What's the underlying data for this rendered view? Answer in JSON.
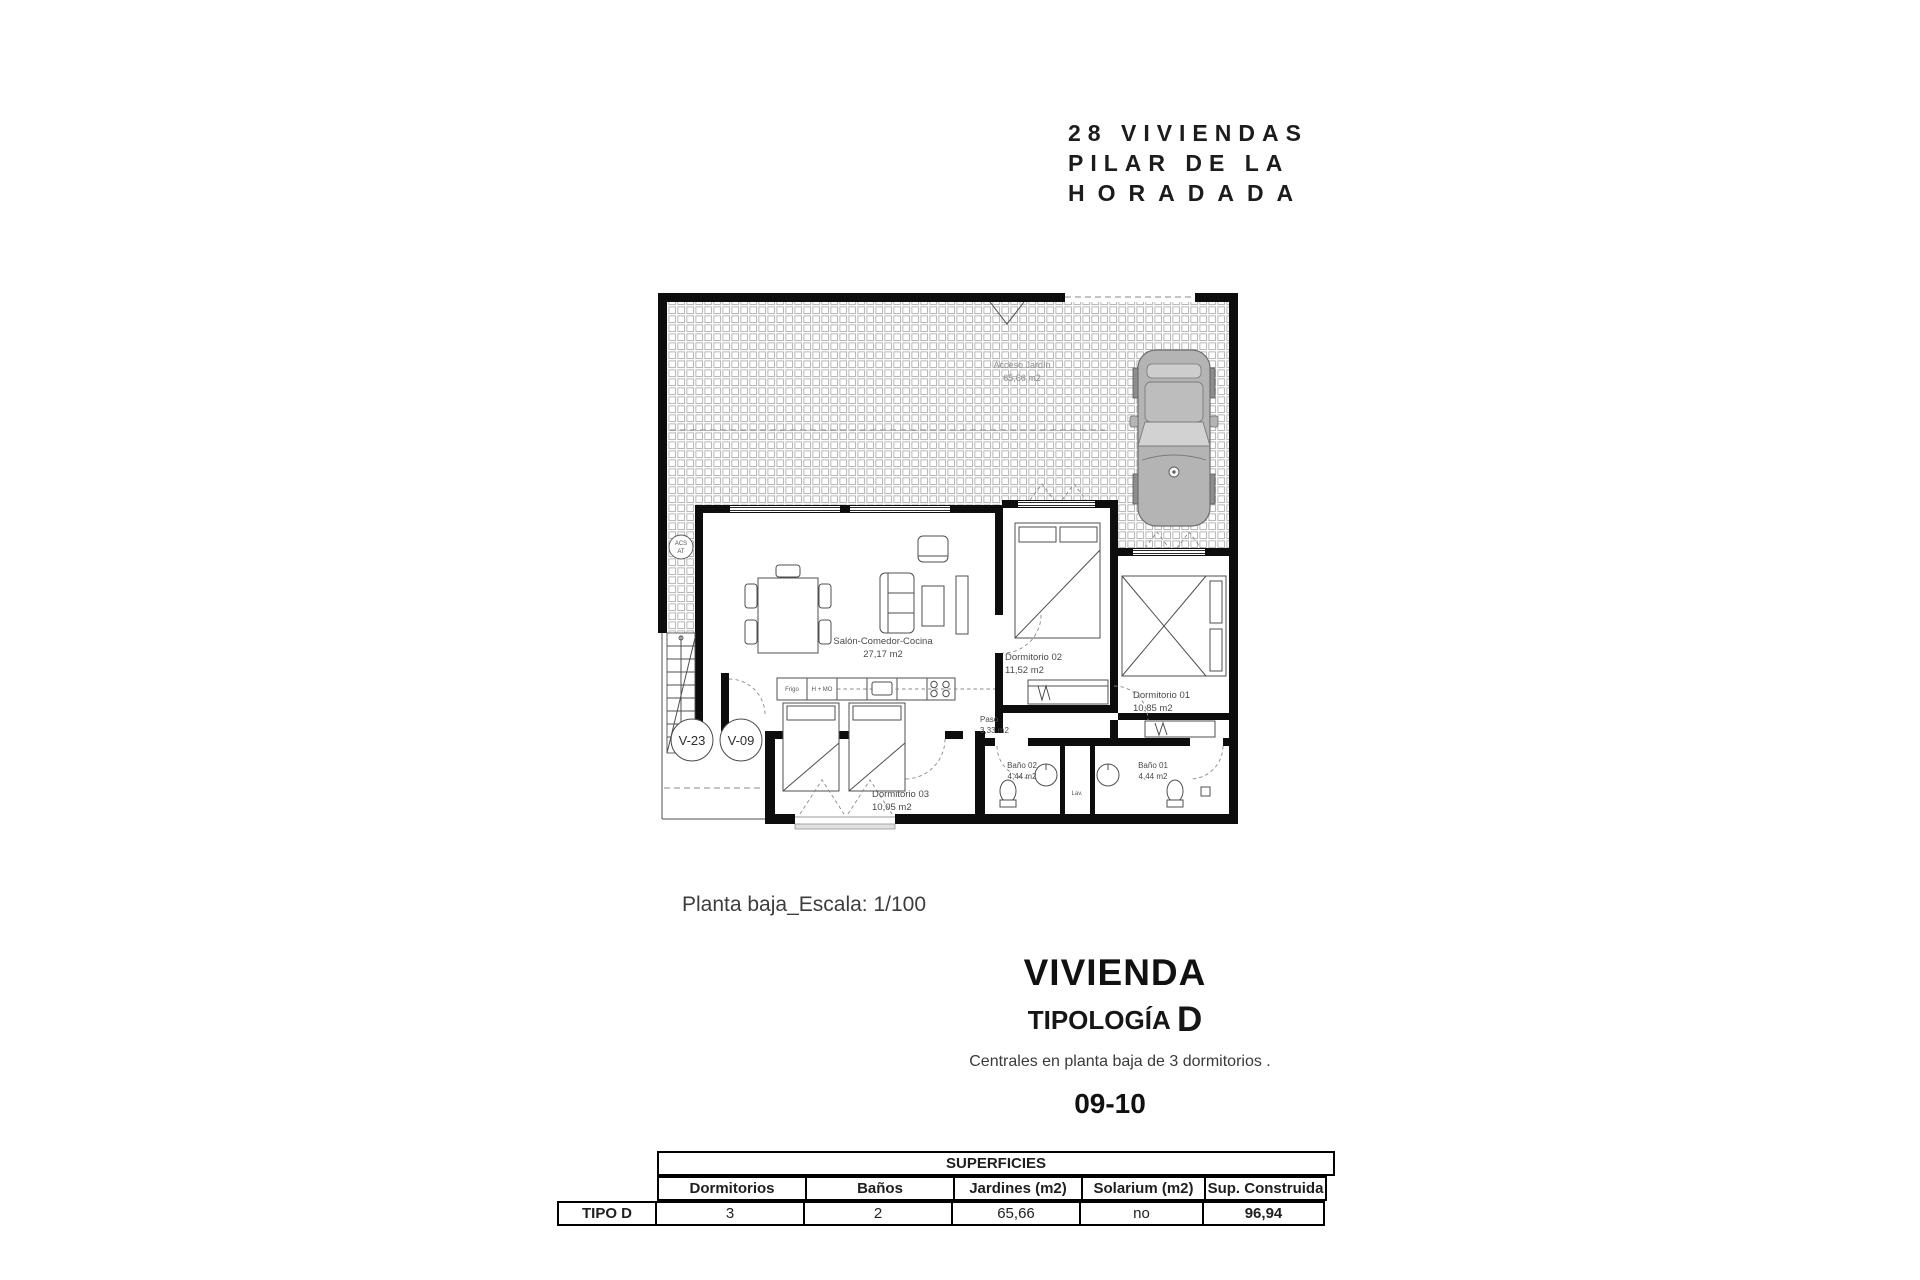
{
  "header": {
    "line1": "28 VIVIENDAS",
    "line2": "PILAR DE LA",
    "line3": "HORADADA"
  },
  "plan": {
    "garden": {
      "name": "Acceso Jardín",
      "area": "65,66 m2"
    },
    "living": {
      "name": "Salón-Comedor-Cocina",
      "area": "27,17 m2"
    },
    "dorm2": {
      "name": "Dormitorio 02",
      "area": "11,52 m2"
    },
    "dorm1": {
      "name": "Dormitorio 01",
      "area": "10,85 m2"
    },
    "dorm3": {
      "name": "Dormitorio 03",
      "area": "10,05 m2"
    },
    "paso": {
      "name": "Paso",
      "area": "3,33 m2"
    },
    "bath2": {
      "name": "Baño 02",
      "area": "4,44 m2"
    },
    "bath1": {
      "name": "Baño 01",
      "area": "4,44 m2"
    },
    "kitchen": {
      "fridge": "Frigo",
      "oven": "H + MO",
      "laundry": "Lav."
    },
    "acs": {
      "line1": "ACS",
      "line2": "AT"
    },
    "tags": {
      "v23": "V-23",
      "v09": "V-09"
    }
  },
  "caption": "Planta baja_Escala: 1/100",
  "section": {
    "title": "VIVIENDA",
    "subtitle": "TIPOLOGÍA",
    "type_letter": "D",
    "description": "Centrales en planta baja de 3 dormitorios .",
    "units": "09-10"
  },
  "table": {
    "superficies": "SUPERFICIES",
    "row_label": "TIPO D",
    "columns": [
      "Dormitorios",
      "Baños",
      "Jardines (m2)",
      "Solarium (m2)",
      "Sup. Construida"
    ],
    "values": [
      "3",
      "2",
      "65,66",
      "no",
      "96,94"
    ]
  },
  "colors": {
    "wall": "#0d0d0d",
    "car_body": "#b4b4b4",
    "label_gray": "#4a4a4a"
  }
}
